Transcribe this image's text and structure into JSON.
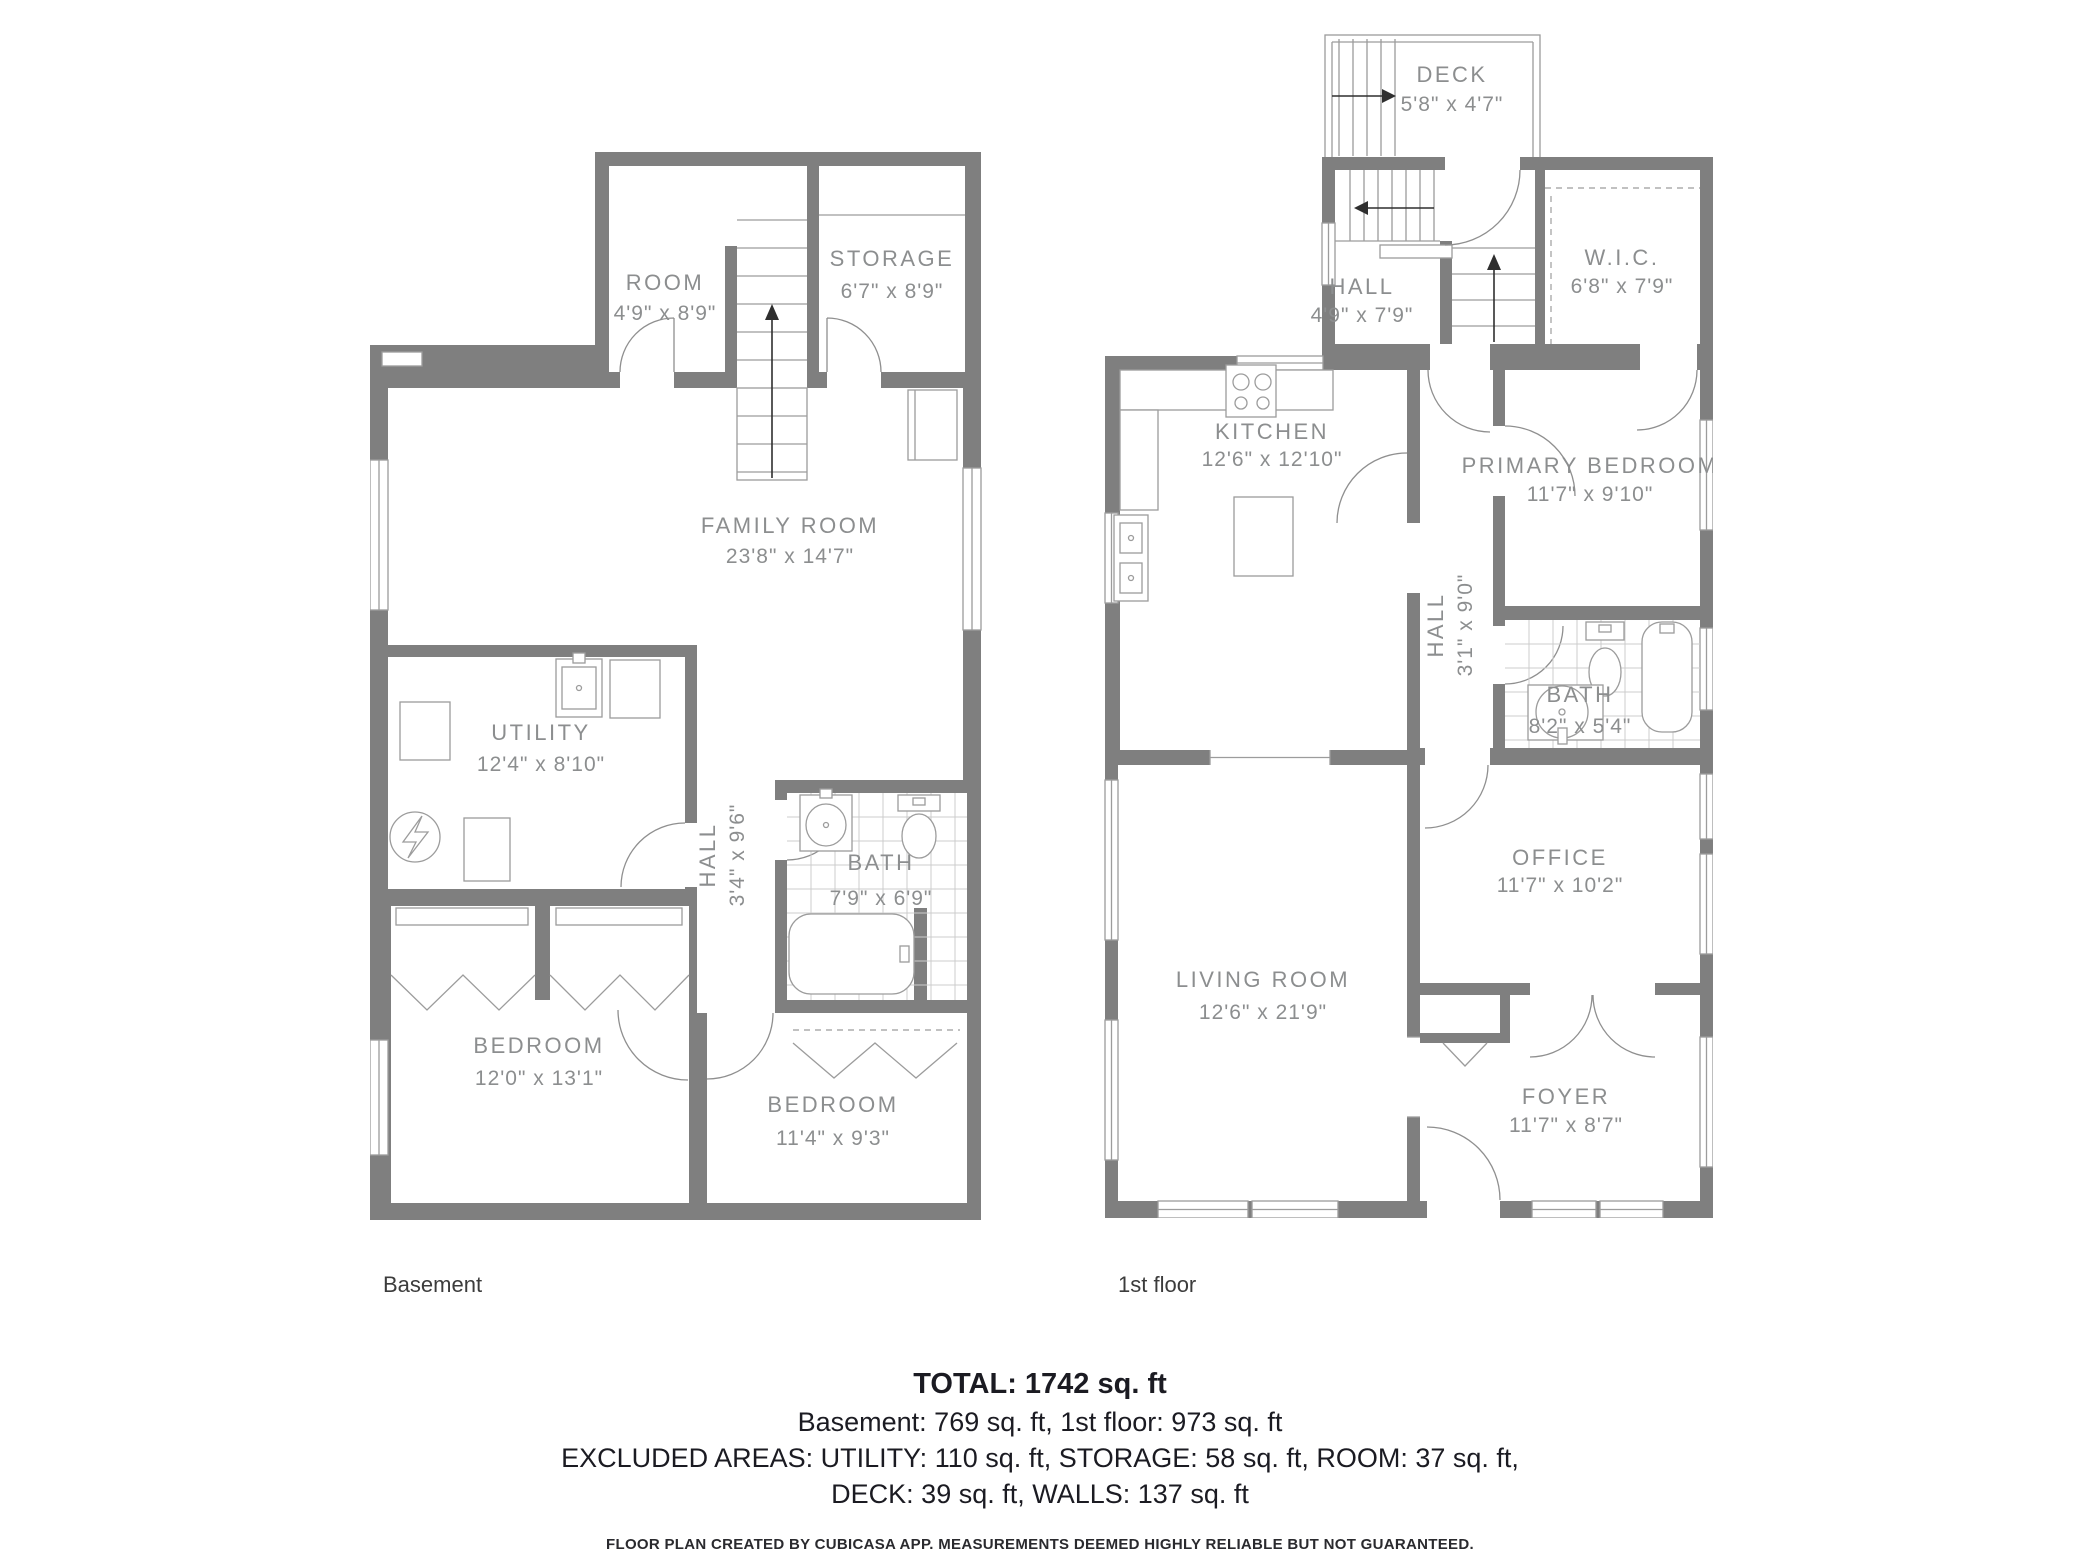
{
  "floors": {
    "basement": {
      "label": "Basement",
      "rooms": {
        "room": {
          "name": "ROOM",
          "dims": "4'9\" x 8'9\""
        },
        "storage": {
          "name": "STORAGE",
          "dims": "6'7\" x 8'9\""
        },
        "family": {
          "name": "FAMILY ROOM",
          "dims": "23'8\" x 14'7\""
        },
        "utility": {
          "name": "UTILITY",
          "dims": "12'4\" x 8'10\""
        },
        "hall": {
          "name": "HALL",
          "dims": "3'4\" x 9'6\""
        },
        "bath": {
          "name": "BATH",
          "dims": "7'9\" x 6'9\""
        },
        "bedroom1": {
          "name": "BEDROOM",
          "dims": "12'0\" x 13'1\""
        },
        "bedroom2": {
          "name": "BEDROOM",
          "dims": "11'4\" x 9'3\""
        }
      }
    },
    "first": {
      "label": "1st floor",
      "rooms": {
        "deck": {
          "name": "DECK",
          "dims": "5'8\" x 4'7\""
        },
        "hall_up": {
          "name": "HALL",
          "dims": "4'9\" x 7'9\""
        },
        "wic": {
          "name": "W.I.C.",
          "dims": "6'8\" x 7'9\""
        },
        "kitchen": {
          "name": "KITCHEN",
          "dims": "12'6\" x 12'10\""
        },
        "primary": {
          "name": "PRIMARY BEDROOM",
          "dims": "11'7\" x 9'10\""
        },
        "hall": {
          "name": "HALL",
          "dims": "3'1\" x 9'0\""
        },
        "bath": {
          "name": "BATH",
          "dims": "8'2\" x 5'4\""
        },
        "living": {
          "name": "LIVING ROOM",
          "dims": "12'6\" x 21'9\""
        },
        "office": {
          "name": "OFFICE",
          "dims": "11'7\" x 10'2\""
        },
        "foyer": {
          "name": "FOYER",
          "dims": "11'7\" x 8'7\""
        }
      }
    }
  },
  "summary": {
    "total": "TOTAL: 1742 sq. ft",
    "floors_line": "Basement: 769 sq. ft, 1st floor: 973 sq. ft",
    "excluded_line1": "EXCLUDED AREAS: UTILITY: 110 sq. ft, STORAGE: 58 sq. ft, ROOM: 37 sq. ft,",
    "excluded_line2": "DECK: 39 sq. ft, WALLS: 137 sq. ft",
    "disclaimer": "FLOOR PLAN CREATED BY CUBICASA APP. MEASUREMENTS DEEMED HIGHLY RELIABLE BUT NOT GUARANTEED."
  },
  "colors": {
    "wall": "#7f7f7f",
    "room_label": "#8c8e8f",
    "line": "#9c9c9c",
    "footer_text": "#1b1b22"
  }
}
